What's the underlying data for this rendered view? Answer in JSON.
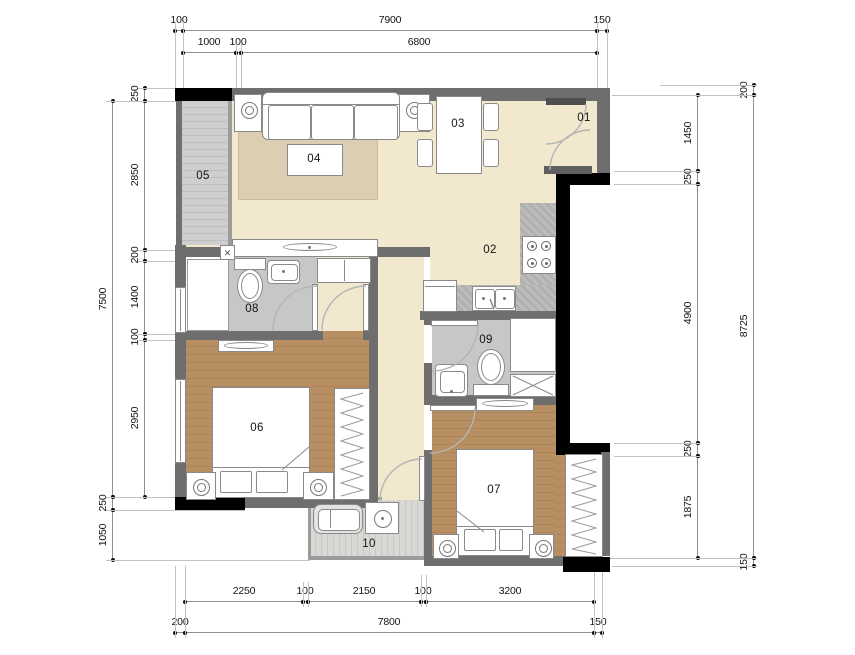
{
  "rooms": {
    "r01": "01",
    "r02": "02",
    "r03": "03",
    "r04": "04",
    "r05": "05",
    "r06": "06",
    "r07": "07",
    "r08": "08",
    "r09": "09",
    "r10": "10"
  },
  "dims": {
    "top1": [
      "100",
      "7900",
      "150"
    ],
    "top2": [
      "1000",
      "100",
      "6800"
    ],
    "left_inner": [
      "250",
      "2850",
      "200",
      "1400",
      "100",
      "2950"
    ],
    "left_outer": [
      "7500",
      "250",
      "1050"
    ],
    "right_inner": [
      "1450",
      "250",
      "4900",
      "250",
      "1875"
    ],
    "right_outer": [
      "200",
      "8725",
      "150"
    ],
    "bottom1": [
      "2250",
      "100",
      "2150",
      "100",
      "3200"
    ],
    "bottom2": [
      "200",
      "7800",
      "150"
    ]
  },
  "icons": {
    "shaft_cross": "✕"
  },
  "colors": {
    "wall": "#6e6e6e",
    "black_wall": "#000000",
    "floor_main": "#f2e8cd",
    "floor_bedroom": "#b78f63",
    "floor_bath": "#c7c7c7",
    "rug": "#dbcfb1",
    "counter": "#b5b5b3",
    "balcony": "#cecece"
  }
}
